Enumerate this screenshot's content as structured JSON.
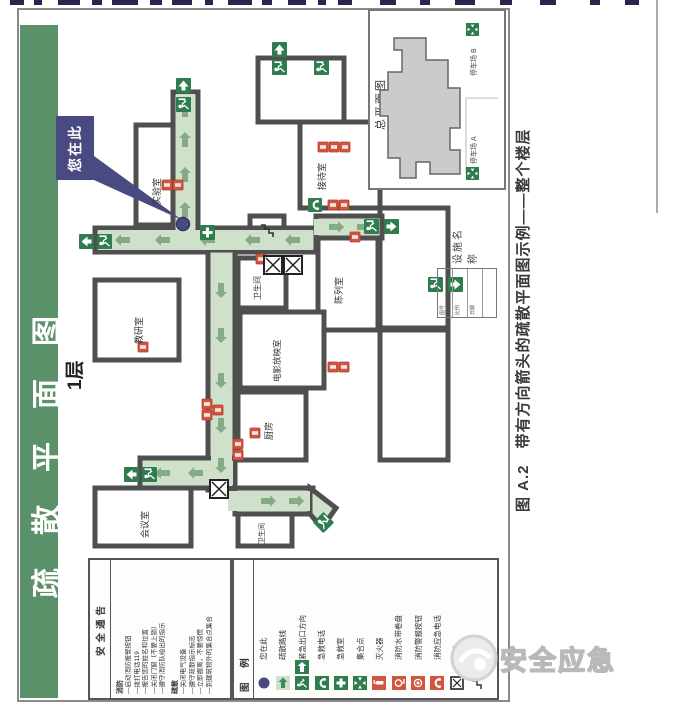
{
  "banner": {
    "title": "疏散平面图",
    "floor": "1层"
  },
  "caption": {
    "text": "图 A.2　带有方向箭头的疏散平面图示例——整个楼层"
  },
  "yah": {
    "label": "您在此"
  },
  "rooms": [
    "实验室",
    "接待室",
    "陈列室",
    "卫生间",
    "教研室",
    "电影放映室",
    "厨房",
    "会议室",
    "卫生间"
  ],
  "inset": {
    "title": "总平面图",
    "parking_a": "停车场 A",
    "parking_b": "停车场 B"
  },
  "facility": {
    "label": "设施名称",
    "rows": [
      "图号",
      "比例",
      "日期"
    ]
  },
  "notice": {
    "title": "安全通告",
    "fire_title": "消防",
    "fire_items": [
      "—启动消防报警按钮",
      "—拨打电话119",
      "—报告您的姓名和位置",
      "—关闭门窗（不要上锁）",
      "—遵守消防队给出的指示"
    ],
    "evac_title": "疏散",
    "evac_items": [
      "—关闭电气设备",
      "—遵守疏散指示标志",
      "—立即撤离，不要惊慌",
      "—到建筑物外的集合点集合"
    ]
  },
  "legend": {
    "title": "图 例",
    "items": [
      {
        "icon": "you-are-here-dot",
        "label": "您在此"
      },
      {
        "icon": "evacuation-route-arrow",
        "label": "疏散路线"
      },
      {
        "icon": "emergency-exit-direction",
        "label": "紧急出口方向"
      },
      {
        "icon": "first-aid-phone",
        "label": "急救电话"
      },
      {
        "icon": "first-aid-room",
        "label": "急救室"
      },
      {
        "icon": "assembly-point",
        "label": "集合点"
      },
      {
        "icon": "fire-extinguisher",
        "label": "灭火器"
      },
      {
        "icon": "fire-hose-reel",
        "label": "消防水带卷盘"
      },
      {
        "icon": "fire-alarm-button",
        "label": "消防警报按钮"
      },
      {
        "icon": "fire-emergency-phone",
        "label": "消防应急电话"
      },
      {
        "icon": "elevator",
        "label": "电梯"
      },
      {
        "icon": "stairs",
        "label": "楼梯"
      }
    ]
  },
  "watermark": {
    "text": "安全应急"
  },
  "colors": {
    "banner_green": "#5a9168",
    "corridor_green": "#cfe0cb",
    "exit_green": "#2f7d4e",
    "alarm_red": "#d4553f",
    "marker_purple": "#4a4a82",
    "wall_gray": "#4f4f4f",
    "building_gray": "#cbcbcb"
  }
}
